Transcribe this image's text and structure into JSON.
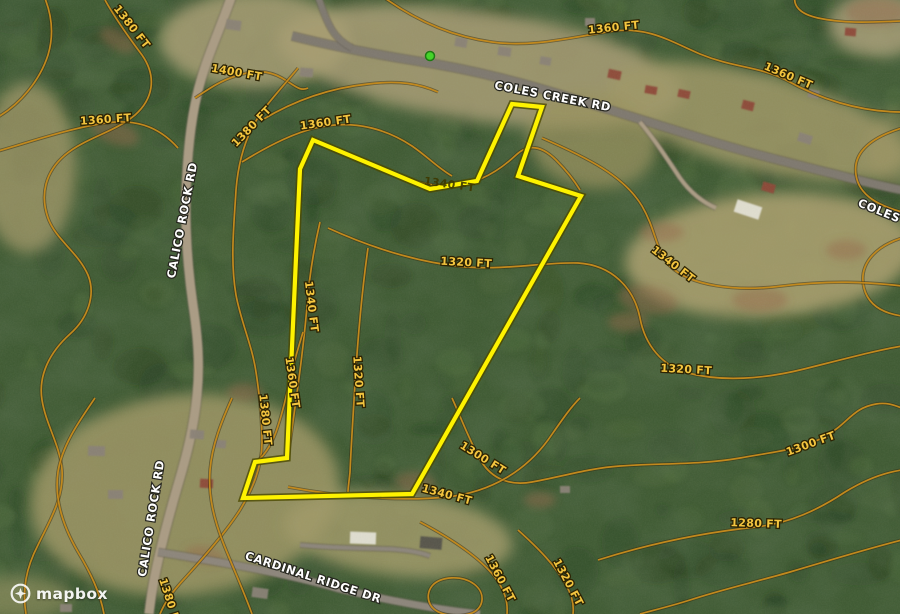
{
  "map": {
    "attribution": {
      "brand": "mapbox"
    },
    "colors": {
      "forest_base": "#415c35",
      "forest_dark": "#243c1e",
      "forest_light": "#5f7c45",
      "contour": "#c2891d",
      "contour_halo": "#33290e",
      "boundary": "#fef200",
      "boundary_halo": "#4c4a00",
      "marker_green": "#46d42a",
      "marker_ring": "#1e7a12",
      "road_paved": "#7f7970",
      "road_light": "#8d867b",
      "road_dirt": "#ab9c85",
      "road_casing": "#5f584e",
      "house_g": "#8a8277",
      "house_r": "#8e4a39",
      "house_w": "#e4e1d6",
      "house_d": "#55524b"
    },
    "marker": {
      "x": 430,
      "y": 56
    },
    "property_boundary": {
      "points": "313,140 430,189 477,181 512,104 542,107 518,176 581,196 412,494 243,498 255,462 287,458 300,169"
    },
    "elevation_labels": [
      {
        "t": "1380 FT",
        "x": 129,
        "y": 29,
        "r": 52
      },
      {
        "t": "1400 FT",
        "x": 236,
        "y": 76,
        "r": 10
      },
      {
        "t": "1360 FT",
        "x": 106,
        "y": 123,
        "r": -4
      },
      {
        "t": "1380 FT",
        "x": 254,
        "y": 129,
        "r": -46
      },
      {
        "t": "1360 FT",
        "x": 326,
        "y": 126,
        "r": -8
      },
      {
        "t": "1360 FT",
        "x": 614,
        "y": 31,
        "r": -6
      },
      {
        "t": "1360 FT",
        "x": 787,
        "y": 79,
        "r": 23
      },
      {
        "t": "1320 FT",
        "x": 466,
        "y": 266,
        "r": 3
      },
      {
        "t": "1340 FT",
        "x": 308,
        "y": 307,
        "r": 83
      },
      {
        "t": "1360 FT",
        "x": 289,
        "y": 383,
        "r": 82
      },
      {
        "t": "1380 FT",
        "x": 262,
        "y": 420,
        "r": 84
      },
      {
        "t": "1320 FT",
        "x": 355,
        "y": 382,
        "r": 86
      },
      {
        "t": "1340 FT",
        "x": 449,
        "y": 188,
        "r": 8,
        "dark": true
      },
      {
        "t": "1340 FT",
        "x": 671,
        "y": 267,
        "r": 38
      },
      {
        "t": "1320 FT",
        "x": 686,
        "y": 373,
        "r": 3
      },
      {
        "t": "1300 FT",
        "x": 812,
        "y": 447,
        "r": -20
      },
      {
        "t": "1280 FT",
        "x": 756,
        "y": 527,
        "r": 2
      },
      {
        "t": "1300 FT",
        "x": 481,
        "y": 461,
        "r": 32
      },
      {
        "t": "1340 FT",
        "x": 446,
        "y": 498,
        "r": 15
      },
      {
        "t": "1360 FT",
        "x": 497,
        "y": 580,
        "r": 62
      },
      {
        "t": "1320 FT",
        "x": 565,
        "y": 584,
        "r": 62
      },
      {
        "t": "1380 FT",
        "x": 167,
        "y": 604,
        "r": 72
      }
    ],
    "road_labels": [
      {
        "t": "COLES CREEK RD",
        "x": 552,
        "y": 100,
        "r": 11
      },
      {
        "t": "COLES CREEK RD",
        "x": 912,
        "y": 228,
        "r": 22
      },
      {
        "t": "CALICO ROCK RD",
        "x": 186,
        "y": 221,
        "r": -79
      },
      {
        "t": "CALICO ROCK RD",
        "x": 155,
        "y": 519,
        "r": -81
      },
      {
        "t": "CARDINAL RIDGE DR",
        "x": 312,
        "y": 581,
        "r": 18
      }
    ],
    "contour_paths": [
      "M -4,118 C 20,105 40,80 48,55 C 54,35 52,15 44,-4",
      "M 105,0 C 115,18 127,35 142,55 C 158,78 152,100 135,115 C 115,132 85,138 65,155 C 45,172 40,195 48,218 C 56,240 78,252 88,275 C 96,295 88,318 70,334 C 50,352 38,375 42,400 C 46,425 60,445 62,470 C 64,498 50,520 38,545 C 26,568 22,590 26,614",
      "M -5,152 C 30,142 70,128 106,123 C 140,118 162,130 178,148",
      "M 195,98 C 210,88 222,80 236,76 C 254,70 268,70 282,78 C 294,85 300,92 308,88",
      "M 298,68 C 282,88 262,108 252,128 C 243,146 238,165 236,190 C 234,225 230,260 236,295 C 241,322 252,345 256,372 C 260,398 262,420 262,442 C 262,468 252,490 240,510 C 226,532 205,556 185,578 C 172,592 165,602 160,614",
      "M 242,162 C 268,146 298,130 326,126 C 358,121 388,130 412,146 C 428,157 438,168 452,176",
      "M 262,120 C 295,100 330,88 368,84 C 400,80 420,84 438,92",
      "M 382,-4 C 412,18 448,36 492,42 C 534,48 576,36 614,31 C 648,27 668,40 700,54 C 734,68 758,66 786,80 C 818,98 858,112 902,112",
      "M 795,-4 C 793,6 800,14 818,18 C 846,24 874,22 902,21",
      "M 902,128 C 876,136 852,150 856,175 C 859,196 880,206 902,212",
      "M 902,238 C 876,246 858,264 864,288 C 869,308 888,314 902,316",
      "M 542,138 C 588,158 624,176 642,206 C 656,230 656,252 670,266 C 690,286 736,292 782,286 C 830,280 868,282 902,286",
      "M 328,228 C 372,248 420,263 466,267 C 508,270 545,262 578,263 C 612,265 634,288 640,318 C 645,345 662,366 688,373 C 722,382 764,379 804,369 C 848,358 878,350 902,346",
      "M 452,398 C 462,420 470,442 481,461 C 492,479 510,486 532,482 C 560,477 590,468 620,466 C 660,463 700,465 740,458 C 772,452 800,450 824,437 C 848,424 852,408 876,404 C 888,402 896,406 902,408",
      "M 598,560 C 636,548 690,534 756,527 C 790,523 818,510 845,492 C 868,478 888,472 902,470",
      "M 902,540 C 870,548 830,560 790,572 C 755,582 720,590 690,600 C 668,607 650,611 640,614",
      "M 288,487 C 336,496 396,502 447,497 C 492,492 526,470 548,440 C 562,420 570,408 580,398",
      "M 420,522 C 450,538 478,556 494,576 C 505,590 508,602 507,614",
      "M 518,530 C 538,548 556,566 566,585 C 573,597 574,606 573,614",
      "M 432,586 C 440,576 462,575 474,584 C 486,593 484,608 472,613 C 458,618 436,616 430,604 C 427,598 428,591 432,586 Z",
      "M 95,398 C 80,420 62,445 58,472 C 54,500 64,528 78,552 C 90,572 100,592 104,614",
      "M 232,398 C 222,420 212,445 210,470 C 208,496 214,520 224,545 C 234,570 244,592 252,614",
      "M 320,222 C 314,248 309,278 307,307 C 304,340 300,372 296,400 C 293,422 290,442 288,458",
      "M 303,332 C 297,352 292,368 289,384 C 285,402 281,418 276,432 C 270,448 262,458 254,464",
      "M 368,248 C 362,290 358,336 355,383 C 353,418 351,448 350,472 C 349,482 348,488 348,492",
      "M 380,168 C 406,180 430,187 452,186 C 478,184 500,170 516,155 C 530,142 544,148 556,160 C 566,170 574,180 580,190"
    ],
    "road_paths": [
      {
        "d": "M 292,36 C 340,48 390,57 435,64 C 480,72 520,82 562,95 C 610,110 655,124 700,138 C 745,152 790,163 830,173 C 858,180 880,186 902,190",
        "w": 8,
        "k": "road_paved"
      },
      {
        "d": "M 318,-4 C 322,8 326,20 332,30 C 337,38 344,44 352,48",
        "w": 6,
        "k": "road_paved"
      },
      {
        "d": "M 232,-5 C 220,30 205,60 197,95 C 190,125 187,160 186,195 C 185,235 188,270 193,305 C 198,338 200,365 197,395 C 194,428 186,458 177,488 C 169,516 161,545 155,575 C 151,595 150,605 149,614",
        "w": 9,
        "k": "road_dirt"
      },
      {
        "d": "M 158,552 C 220,562 280,572 340,589 C 395,602 440,610 480,614",
        "w": 7,
        "k": "road_light"
      },
      {
        "d": "M 640,122 C 655,140 668,160 680,178 C 690,192 702,202 716,208",
        "w": 4,
        "k": "road_dirt"
      },
      {
        "d": "M 300,545 C 330,548 360,548 390,549 C 408,550 420,552 430,556",
        "w": 4,
        "k": "road_light"
      }
    ],
    "clearings": [
      [
        480,
        66,
        205,
        55,
        8,
        0.9,
        "#a49a72"
      ],
      [
        255,
        40,
        95,
        48,
        0,
        0.85,
        "#a89d74"
      ],
      [
        758,
        122,
        155,
        48,
        14,
        0.85,
        "#a09868"
      ],
      [
        28,
        168,
        48,
        85,
        0,
        0.8,
        "#9f9668"
      ],
      [
        770,
        255,
        145,
        62,
        -4,
        0.9,
        "#a89e6f"
      ],
      [
        185,
        495,
        155,
        100,
        -6,
        0.9,
        "#9a9464"
      ],
      [
        398,
        534,
        115,
        42,
        6,
        0.85,
        "#a19a6a"
      ],
      [
        592,
        140,
        65,
        48,
        10,
        0.75,
        "#99915f"
      ],
      [
        878,
        25,
        50,
        32,
        0,
        0.8,
        "#b0a47e"
      ],
      [
        18,
        598,
        55,
        22,
        0,
        0.6,
        "#9a9464"
      ],
      [
        895,
        150,
        30,
        40,
        0,
        0.5,
        "#a09868"
      ]
    ],
    "dirt_patches": [
      [
        648,
        300,
        30,
        14,
        10
      ],
      [
        662,
        232,
        22,
        10,
        0
      ],
      [
        115,
        132,
        25,
        12,
        20
      ],
      [
        245,
        392,
        18,
        9,
        0
      ],
      [
        415,
        482,
        20,
        10,
        5
      ],
      [
        760,
        300,
        28,
        12,
        0
      ],
      [
        628,
        322,
        20,
        10,
        0
      ],
      [
        118,
        40,
        20,
        10,
        30
      ],
      [
        876,
        12,
        30,
        14,
        0
      ],
      [
        846,
        250,
        20,
        10,
        0
      ],
      [
        540,
        500,
        16,
        8,
        0
      ],
      [
        205,
        555,
        20,
        9,
        10
      ]
    ],
    "houses": [
      [
        226,
        20,
        15,
        10,
        8,
        "g"
      ],
      [
        300,
        68,
        13,
        9,
        5,
        "g"
      ],
      [
        455,
        38,
        12,
        9,
        10,
        "g"
      ],
      [
        498,
        47,
        13,
        9,
        8,
        "g"
      ],
      [
        540,
        57,
        11,
        8,
        10,
        "g"
      ],
      [
        585,
        18,
        10,
        8,
        0,
        "g"
      ],
      [
        608,
        70,
        13,
        9,
        12,
        "r"
      ],
      [
        645,
        86,
        12,
        8,
        10,
        "r"
      ],
      [
        678,
        90,
        12,
        8,
        12,
        "r"
      ],
      [
        742,
        101,
        12,
        9,
        14,
        "r"
      ],
      [
        762,
        183,
        13,
        9,
        16,
        "r"
      ],
      [
        808,
        90,
        11,
        8,
        10,
        "g"
      ],
      [
        798,
        134,
        14,
        9,
        18,
        "g"
      ],
      [
        845,
        28,
        11,
        8,
        5,
        "r"
      ],
      [
        862,
        202,
        14,
        9,
        20,
        "g"
      ],
      [
        735,
        203,
        26,
        13,
        18,
        "w"
      ],
      [
        88,
        446,
        17,
        10,
        2,
        "g"
      ],
      [
        108,
        490,
        15,
        9,
        0,
        "g"
      ],
      [
        190,
        430,
        14,
        9,
        5,
        "g"
      ],
      [
        214,
        440,
        12,
        8,
        5,
        "g"
      ],
      [
        200,
        479,
        13,
        9,
        3,
        "r"
      ],
      [
        252,
        588,
        16,
        10,
        8,
        "g"
      ],
      [
        60,
        604,
        12,
        8,
        0,
        "g"
      ],
      [
        350,
        532,
        26,
        12,
        2,
        "w"
      ],
      [
        420,
        537,
        22,
        12,
        5,
        "d"
      ],
      [
        560,
        486,
        10,
        7,
        0,
        "g"
      ]
    ]
  }
}
